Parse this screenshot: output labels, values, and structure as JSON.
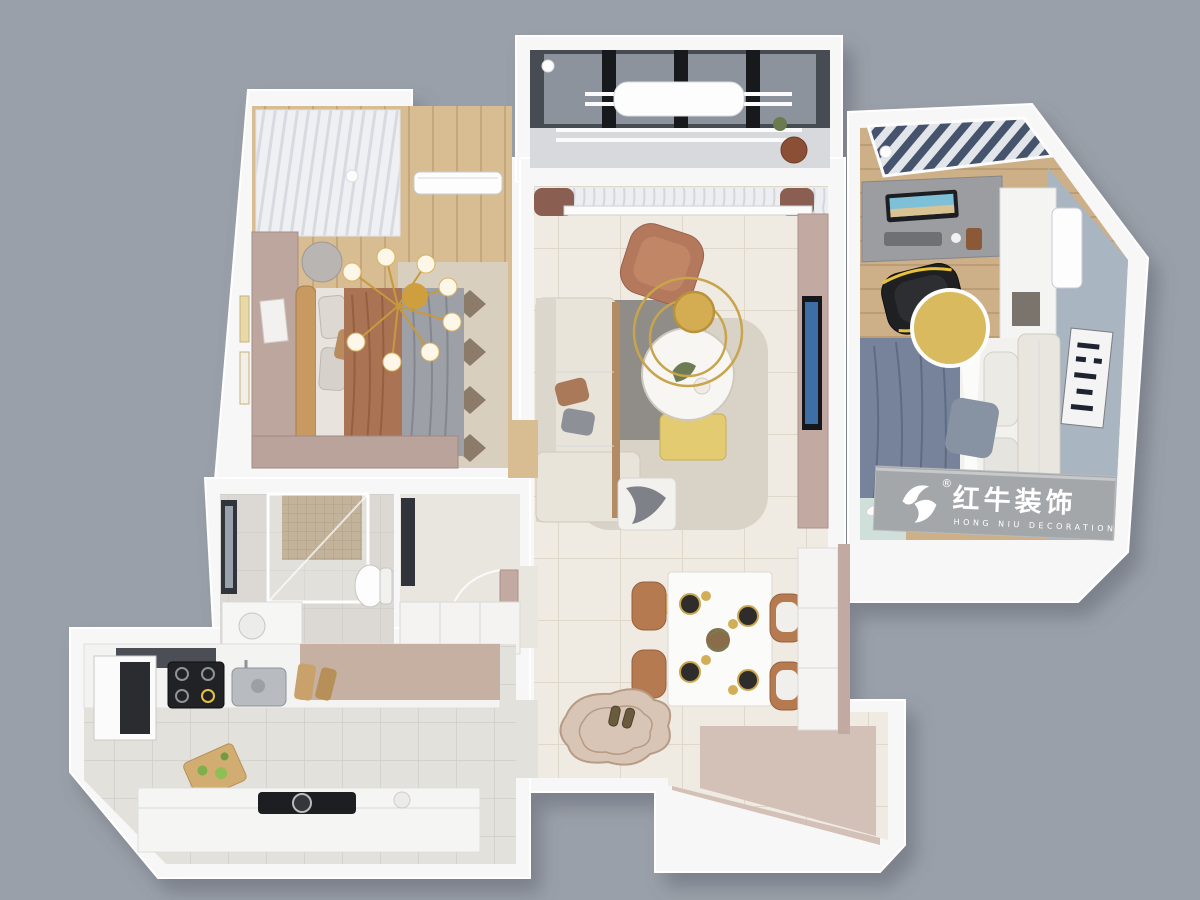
{
  "scene": {
    "description": "3D isometric top-down render of a three-room apartment floor plan",
    "background_color": "#9aa0a9",
    "wall_color": "#f7f7f8",
    "exposed_wall_face_color": "#d3c0b7"
  },
  "brand": {
    "name": "红牛装饰",
    "subtitle": "HONG NIU DECORATION",
    "registered_mark": "®",
    "icon": "bull-logo-icon",
    "text_color": "#ffffff",
    "sign_wall_color": "#a4a7aa"
  },
  "rooms": [
    {
      "id": "master-bedroom",
      "floor_color": "#d8bc92",
      "features": [
        "double-bed",
        "tan-headboard",
        "brown-and-gray-bedding",
        "gold-chandelier",
        "vanity-desk",
        "wardrobe",
        "window-seat",
        "air-conditioner",
        "wall-frames",
        "patterned-rug"
      ]
    },
    {
      "id": "laundry-balcony",
      "floor_color": "#d7d9dc",
      "features": [
        "dark-glazed-windows",
        "drying-racks",
        "laundry-cover",
        "chair",
        "plant"
      ]
    },
    {
      "id": "living-room",
      "floor_color": "#efeae2",
      "features": [
        "cream-l-sofa",
        "terracotta-lounge-chair",
        "round-coffee-table",
        "gold-ring-chandelier",
        "tv-wall",
        "sheer-curtains",
        "two-tone-rug",
        "gold-bench",
        "knit-throw-ottoman"
      ]
    },
    {
      "id": "dining-area",
      "floor_color": "#efeae2",
      "features": [
        "white-dining-table",
        "four-leather-chairs",
        "black-plates",
        "gold-linear-pendant",
        "sideboard"
      ]
    },
    {
      "id": "second-bedroom",
      "floor_color": "#cdb088",
      "features": [
        "navy-duvet-bed",
        "cream-headboard",
        "desk-with-monitor",
        "gaming-chair",
        "white-wardrobe",
        "air-conditioner",
        "abstract-wall-art",
        "gold-round-table",
        "brand-sign-wall"
      ]
    },
    {
      "id": "bathroom",
      "floor_color": "#dcd9d4",
      "features": [
        "glass-shower",
        "mosaic-wall",
        "toilet",
        "vanity",
        "window"
      ]
    },
    {
      "id": "hallway",
      "floor_color": "#e9e6e0",
      "features": [
        "door",
        "storage-cabinet",
        "window"
      ]
    },
    {
      "id": "kitchen",
      "floor_color": "#e3e1dc",
      "features": [
        "range-hood",
        "fridge",
        "gas-stove",
        "sink",
        "cutting-boards",
        "island-cooktop"
      ]
    },
    {
      "id": "entry",
      "floor_color": "#efeae2",
      "features": [
        "irregular-swirl-rug",
        "pair-of-shoes"
      ]
    }
  ],
  "palette": {
    "wood_floor": "#d8bc92",
    "tile_floor": "#efeae2",
    "mauve_wall": "#c2aaa2",
    "accent_blue_gray": "#a9b5c0",
    "gold": "#d4ad52",
    "terracotta": "#b4785c",
    "navy_bedding": "#76839a",
    "cream_sofa": "#e9e4da",
    "dark_window": "#33373d"
  }
}
